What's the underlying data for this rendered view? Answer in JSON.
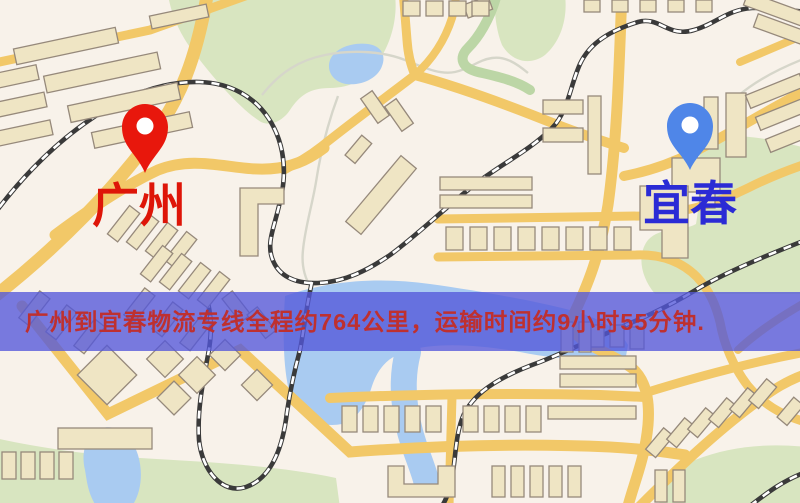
{
  "page": {
    "type": "logistics-route-map"
  },
  "banner": {
    "text": "广州到宜春物流专线全程约764公里，运输时间约9小时55分钟.",
    "bg_color": "#5357DA",
    "text_color": "#BE3030"
  },
  "route": {
    "origin_city": "广州",
    "destination_city": "宜春",
    "distance_km": "764",
    "duration": "9小时55分钟"
  },
  "markers": {
    "origin": {
      "label": "广州",
      "pin_icon": "red-map-pin",
      "pin_color": "#E8170C",
      "label_color": "#DE1508"
    },
    "destination": {
      "label": "宜春",
      "pin_icon": "blue-map-pin",
      "pin_color": "#4F86E8",
      "label_color": "#2B2BD5"
    }
  },
  "map": {
    "colors": {
      "background": "#F8F2EA",
      "road": "#F2C868",
      "building": "#EFE5C4",
      "building_outline": "#96897B",
      "green": "#D8E5C0",
      "water": "#A9CBF1",
      "railway": "#3A3A3A",
      "railway_dash": "#FFFFFF",
      "stream": "#D6D6CA"
    }
  }
}
